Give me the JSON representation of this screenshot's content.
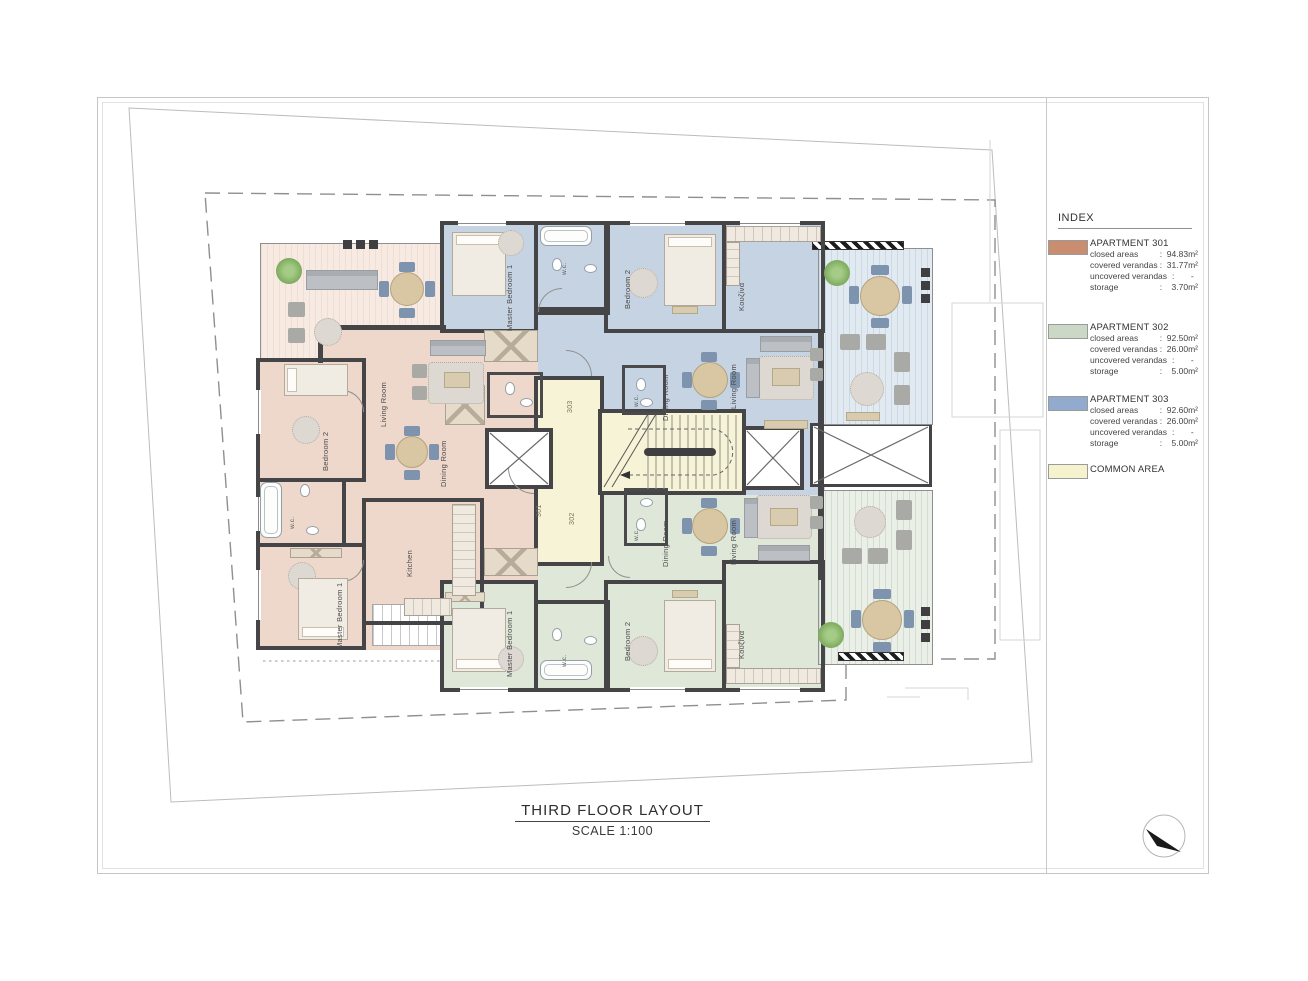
{
  "page": {
    "title": "THIRD FLOOR LAYOUT",
    "scale": "SCALE 1:100"
  },
  "index": {
    "heading": "INDEX",
    "entries": [
      {
        "name": "APARTMENT 301",
        "swatch": "#c98e70",
        "rows": [
          {
            "label": "closed areas",
            "value": ":  94.83m²"
          },
          {
            "label": "covered verandas",
            "value": ":  31.77m²"
          },
          {
            "label": "uncovered verandas",
            "value": ":       -"
          },
          {
            "label": "storage",
            "value": ":    3.70m²"
          }
        ]
      },
      {
        "name": "APARTMENT 302",
        "swatch": "#ccd8c6",
        "rows": [
          {
            "label": "closed areas",
            "value": ":  92.50m²"
          },
          {
            "label": "covered verandas",
            "value": ":  26.00m²"
          },
          {
            "label": "uncovered verandas",
            "value": ":       -"
          },
          {
            "label": "storage",
            "value": ":    5.00m²"
          }
        ]
      },
      {
        "name": "APARTMENT 303",
        "swatch": "#92aacd",
        "rows": [
          {
            "label": "closed areas",
            "value": ":  92.60m²"
          },
          {
            "label": "covered verandas",
            "value": ":  26.00m²"
          },
          {
            "label": "uncovered verandas",
            "value": ":       -"
          },
          {
            "label": "storage",
            "value": ":    5.00m²"
          }
        ]
      },
      {
        "name": "COMMON AREA",
        "swatch": "#f5f2cd",
        "rows": []
      }
    ]
  },
  "rooms": {
    "living": "Living Room",
    "dining": "Dining Room",
    "master": "Master Bedroom 1",
    "bedroom2": "Bedroom 2",
    "kitchen_en": "Kitchen",
    "kitchen_gr": "Κουζίνα",
    "wc": "w.c."
  },
  "units": {
    "u301": "301",
    "u302": "302",
    "u303": "303"
  },
  "colors": {
    "apartment_301": "#c98e70",
    "apartment_302": "#ccd8c6",
    "apartment_303": "#92aacd",
    "common_area": "#f5f2cd",
    "wall": "#454547"
  }
}
